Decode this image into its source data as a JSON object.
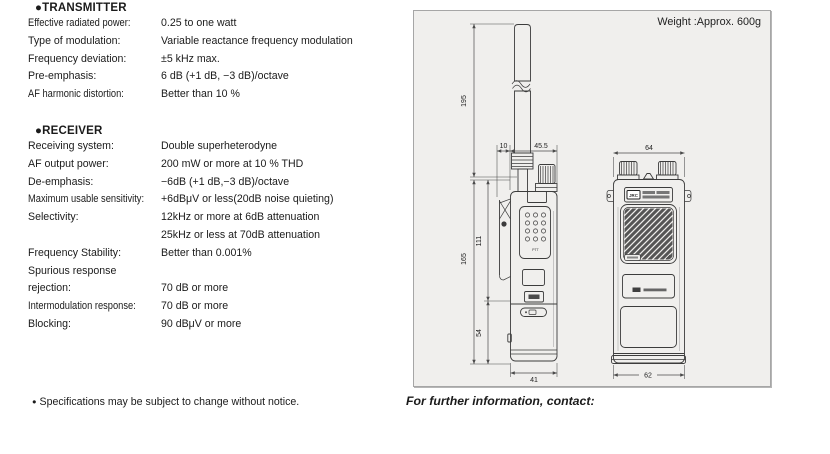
{
  "transmitter": {
    "heading": "●TRANSMITTER",
    "rows": [
      {
        "label": "Effective radiated power:",
        "value": "0.25 to one watt"
      },
      {
        "label": "Type of modulation:",
        "value": "Variable reactance frequency modulation"
      },
      {
        "label": "Frequency deviation:",
        "value": "±5 kHz max."
      },
      {
        "label": "Pre-emphasis:",
        "value": "6 dB (+1 dB, −3 dB)/octave"
      },
      {
        "label": "AF harmonic distortion:",
        "value": "Better than 10 %"
      }
    ]
  },
  "receiver": {
    "heading": "●RECEIVER",
    "rows": [
      {
        "label": "Receiving system:",
        "value": "Double superheterodyne"
      },
      {
        "label": "AF output power:",
        "value": "200 mW or more at 10 % THD"
      },
      {
        "label": "De-emphasis:",
        "value": "−6dB (+1 dB,−3 dB)/octave"
      },
      {
        "label": "Maximum usable sensitivity:",
        "value": "+6dBμV or less(20dB noise quieting)"
      },
      {
        "label": "Selectivity:",
        "value": "12kHz or more at 6dB attenuation"
      },
      {
        "label": "",
        "value": "25kHz or less at 70dB attenuation"
      },
      {
        "label": "Frequency Stability:",
        "value": "Better than 0.001%"
      },
      {
        "label": "Spurious response",
        "value": ""
      },
      {
        "label": "rejection:",
        "value": "70 dB or more"
      },
      {
        "label": "Intermodulation response:",
        "value": "70 dB or more"
      },
      {
        "label": "Blocking:",
        "value": "90 dBμV or more"
      }
    ]
  },
  "outline": {
    "heading": "■ OUTLINE DRAWING",
    "weight_label": "Weight :Approx. 600g",
    "dims": {
      "antenna_length": "195",
      "clip_depth": "10",
      "body_depth": "45.5",
      "front_width_top": "64",
      "body_height": "165",
      "upper_height": "111",
      "lower_height": "54",
      "side_width_bottom": "41",
      "front_width_bottom": "62"
    },
    "device_labels": {
      "keypad_button": "PTT",
      "brand": "JRC"
    }
  },
  "footer": {
    "spec_note_bullet": "●",
    "spec_note": "Specifications may be subject to change without notice.",
    "contact_note": "For further information, contact:"
  },
  "colors": {
    "panel_bg": "#f0efed",
    "panel_border": "#a6a6a6",
    "ink": "#1b1b1b"
  }
}
